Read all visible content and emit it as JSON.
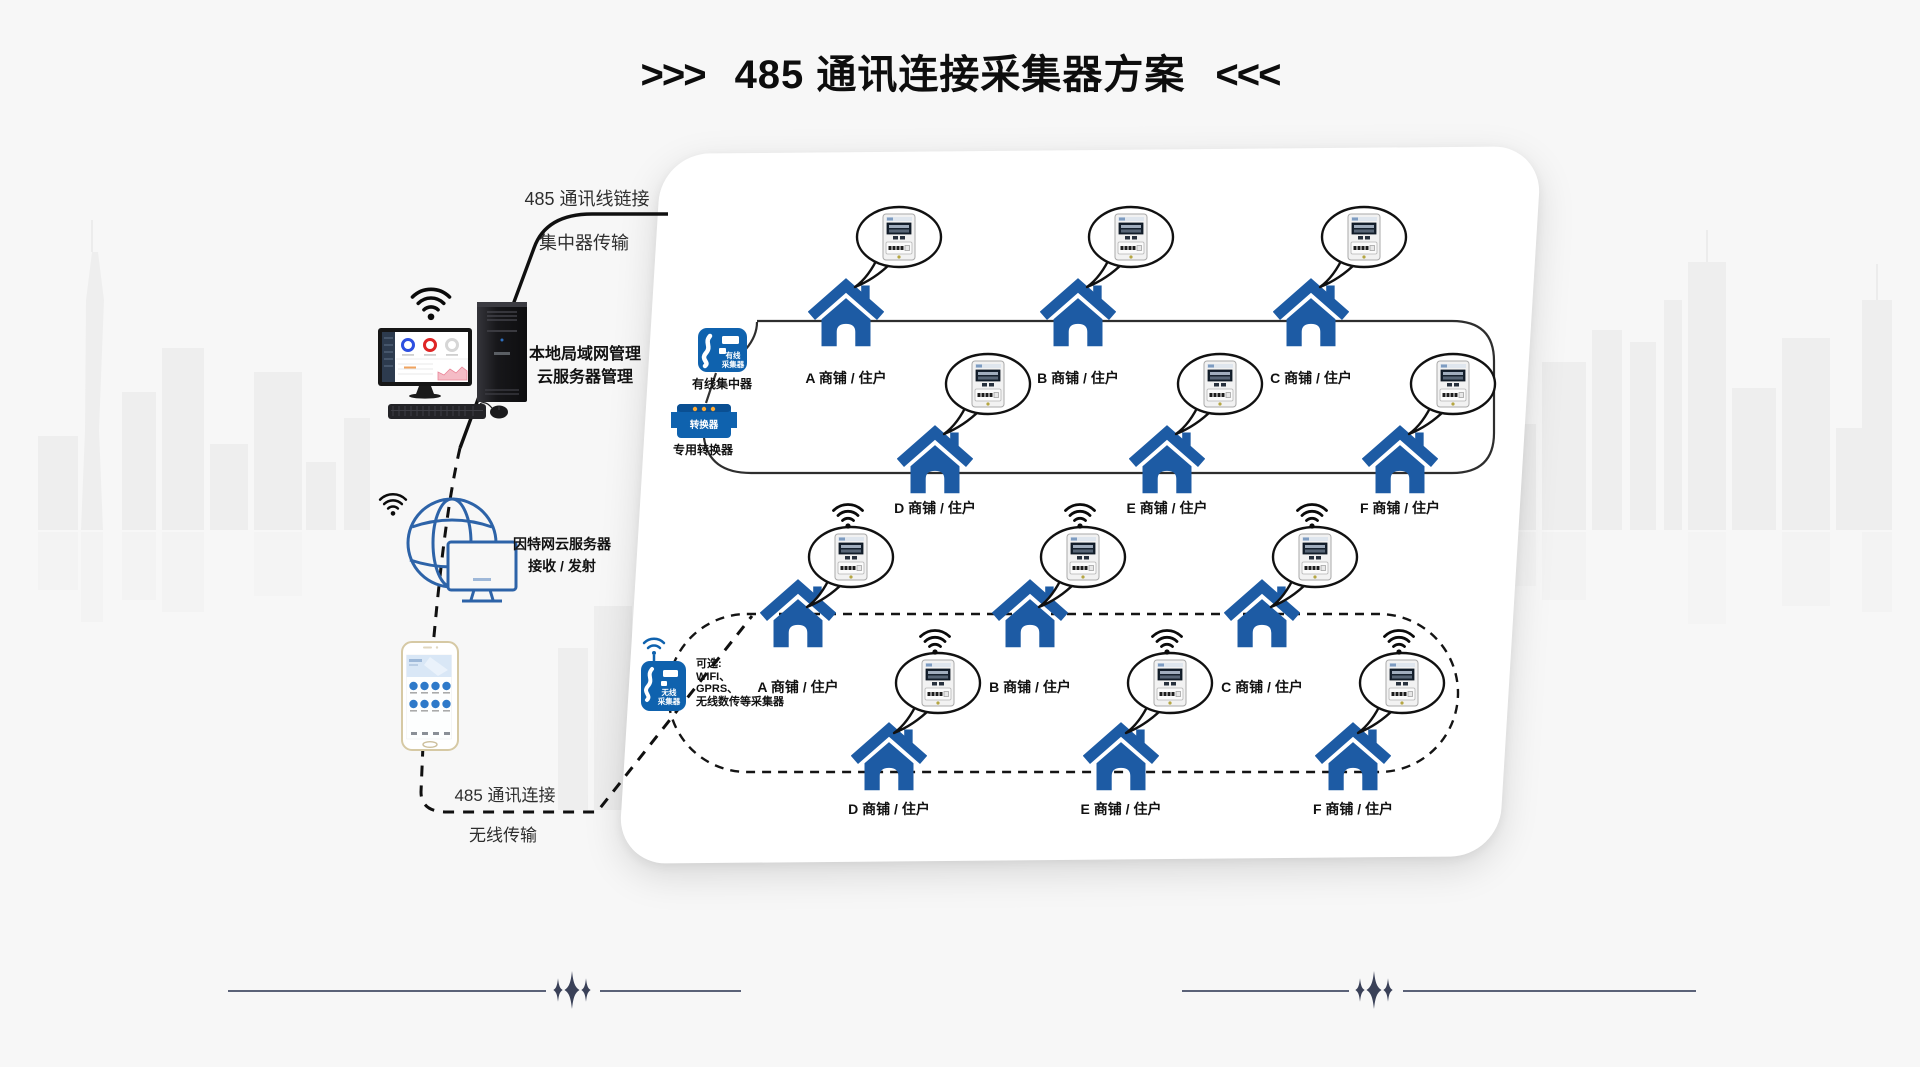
{
  "title": {
    "prefix": ">>>",
    "text": "485 通讯连接采集器方案",
    "suffix": "<<<"
  },
  "left": {
    "wired_link": [
      "485 通讯线链接",
      "集中器传输"
    ],
    "computer_caption": [
      "本地局域网管理",
      "云服务器管理"
    ],
    "internet_caption": [
      "因特网云服务器",
      "接收 / 发射"
    ],
    "wireless_link": [
      "485 通讯连接",
      "无线传输"
    ]
  },
  "panel": {
    "wired": {
      "collector_icon_text": [
        "有线",
        "采集器"
      ],
      "collector_caption": "有线集中器",
      "converter_icon_text": "转换器",
      "converter_caption": "专用转换器",
      "houses": [
        "A 商铺 / 住户",
        "B 商铺 / 住户",
        "C 商铺 / 住户",
        "D 商铺 / 住户",
        "E 商铺 / 住户",
        "F 商铺 / 住户"
      ]
    },
    "wireless": {
      "collector_icon_text": [
        "无线",
        "采集器"
      ],
      "note": [
        "可选:",
        "WIFI、",
        "GPRS、",
        "无线数传等采集器"
      ],
      "houses": [
        "A 商铺 / 住户",
        "B 商铺 / 住户",
        "C 商铺 / 住户",
        "D 商铺 / 住户",
        "E 商铺 / 住户",
        "F 商铺 / 住户"
      ]
    }
  },
  "colors": {
    "house_blue": "#1d5ba4",
    "icon_blue": "#0f62ae",
    "accent_orange": "#ffaa33",
    "line_black": "#111111",
    "background": "#f7f7f7"
  }
}
